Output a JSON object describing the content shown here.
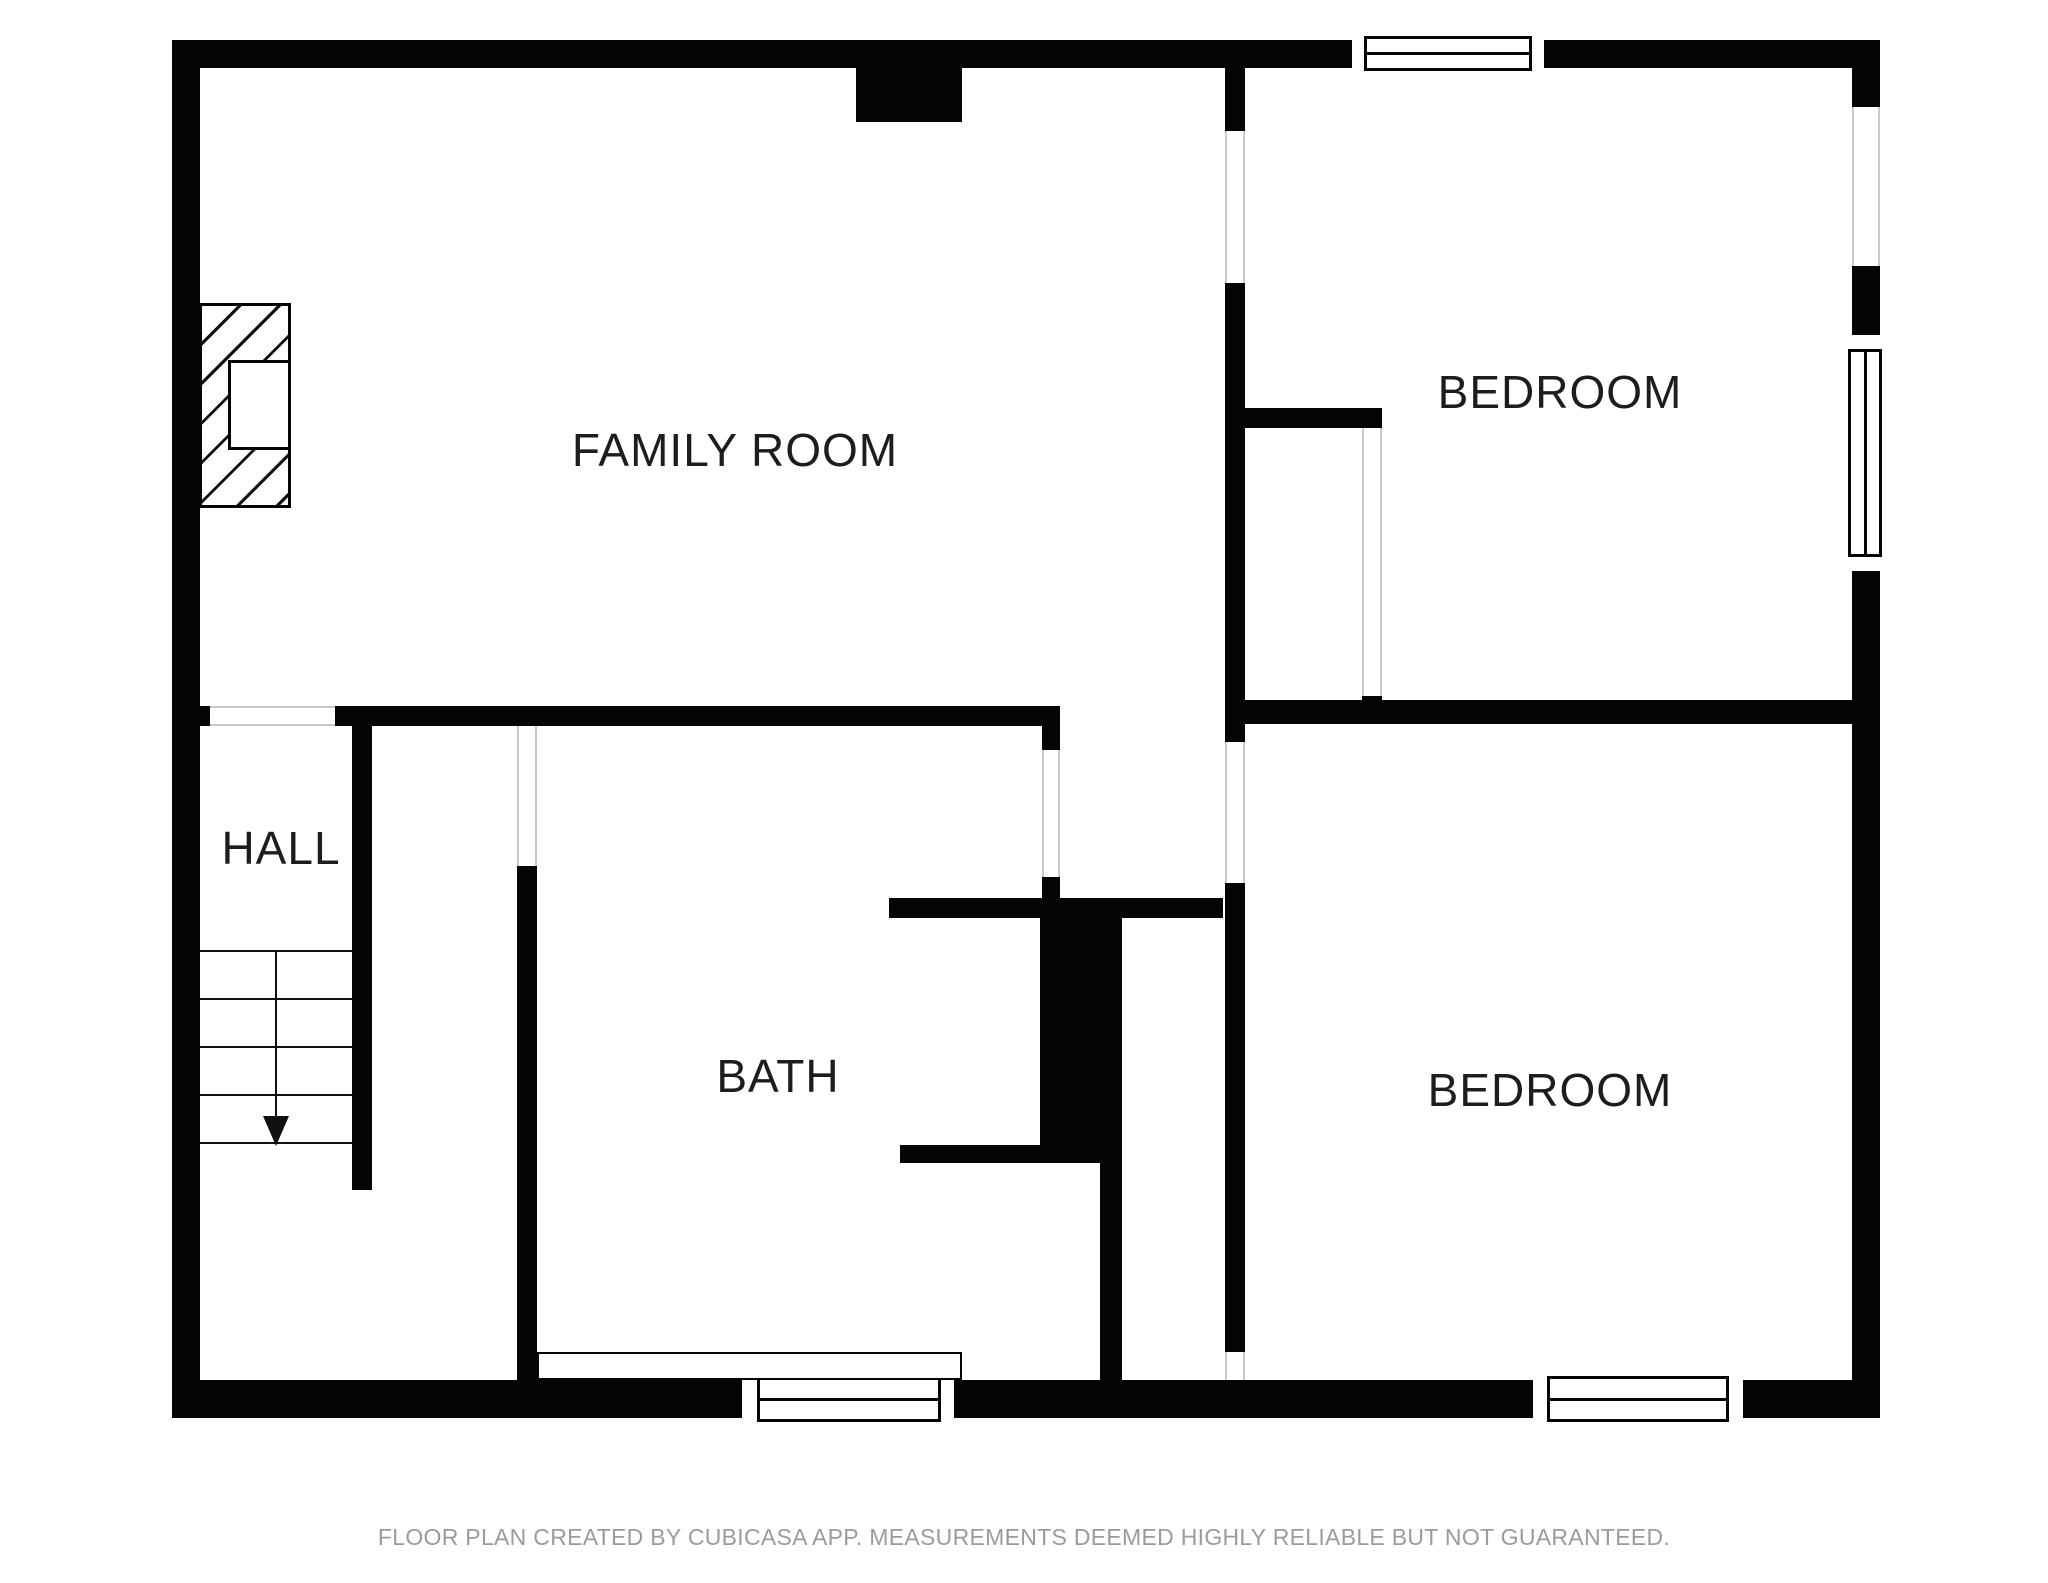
{
  "plan": {
    "type": "floor-plan",
    "rooms": [
      {
        "id": "family-room",
        "label": "FAMILY ROOM"
      },
      {
        "id": "bedroom-top",
        "label": "BEDROOM"
      },
      {
        "id": "hall",
        "label": "HALL"
      },
      {
        "id": "bath",
        "label": "BATH"
      },
      {
        "id": "bedroom-bottom",
        "label": "BEDROOM"
      }
    ],
    "features": {
      "stairs_direction": "down",
      "windows": 4,
      "fireplace": true
    }
  },
  "footer": {
    "disclaimer": "FLOOR PLAN CREATED BY CUBICASA APP. MEASUREMENTS DEEMED HIGHLY RELIABLE BUT NOT GUARANTEED."
  },
  "colors": {
    "wall": "#050505",
    "background": "#ffffff",
    "room_label": "#1d1d1d",
    "footer_text": "#9b9b9b",
    "opening_edge": "#c9c9c9"
  }
}
